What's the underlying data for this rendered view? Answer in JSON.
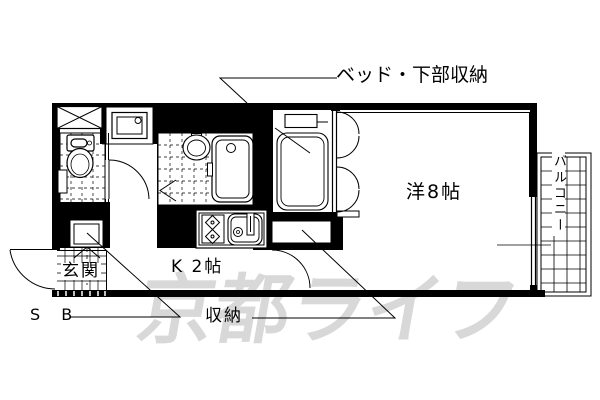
{
  "floorplan": {
    "title_labels": {
      "bed_storage": "ベッド・下部収納",
      "western_room": "洋8帖",
      "kitchen": "K 2帖",
      "entrance": "玄関",
      "storage": "収納",
      "shoe_box": "S B",
      "balcony": "バルコニー"
    },
    "watermark": "京都ライフ",
    "rooms": [
      {
        "name": "western_room",
        "label": "洋8帖",
        "size_tatami": 8
      },
      {
        "name": "kitchen",
        "label": "K 2帖",
        "size_tatami": 2
      }
    ],
    "features": [
      "ベッド・下部収納",
      "収納",
      "S B",
      "玄関",
      "バルコニー",
      "トイレ",
      "浴室",
      "洗濯機置場",
      "キッチン"
    ],
    "colors": {
      "line": "#000000",
      "background": "#ffffff",
      "watermark": "#d8d8d8"
    }
  }
}
